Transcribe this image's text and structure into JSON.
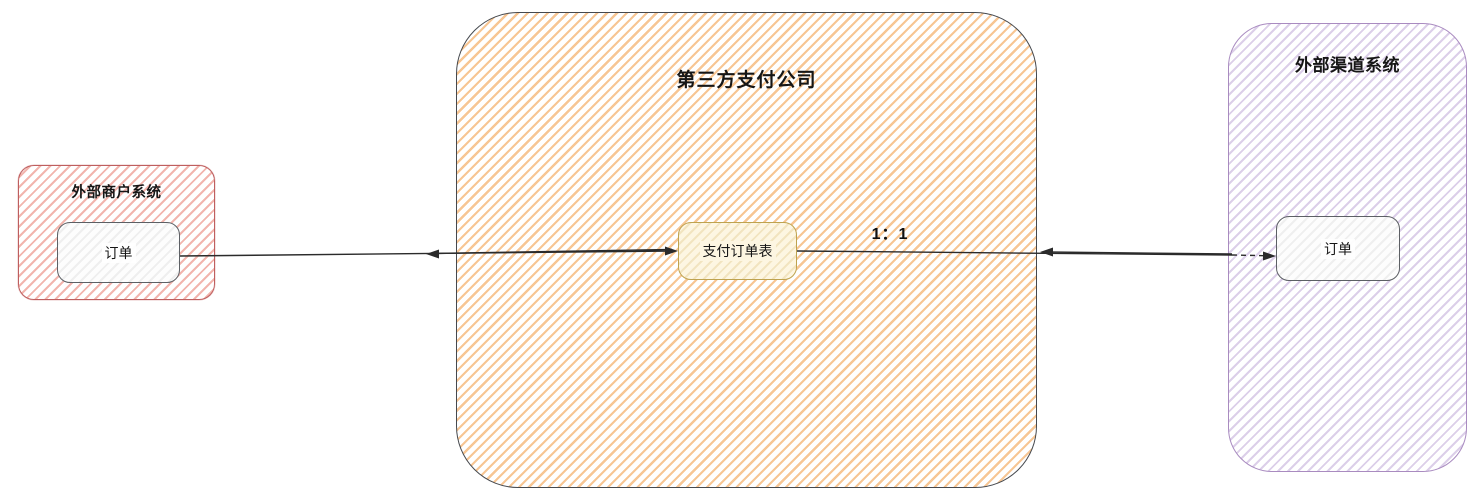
{
  "canvas": {
    "width": 1481,
    "height": 492,
    "background": "#ffffff"
  },
  "nodes": {
    "merchant_system": {
      "label": "外部商户系统",
      "border_color": "#bf5f5f",
      "hatch_color": "#f2b5ae"
    },
    "merchant_order": {
      "label": "订单",
      "border_color": "#5d6065"
    },
    "payment_company": {
      "label": "第三方支付公司",
      "border_color": "#46494e",
      "hatch_color": "#f7c694"
    },
    "payment_order_table": {
      "label": "支付订单表",
      "border_color": "#bfa34f",
      "fill_color": "#fdf6e2"
    },
    "channel_system": {
      "label": "外部渠道系统",
      "border_color": "#a98bc0",
      "hatch_color": "#dccfe9"
    },
    "channel_order": {
      "label": "订单",
      "border_color": "#5d6065"
    }
  },
  "edges": {
    "merchant_to_payment": {
      "style": "solid",
      "arrowheads": "both"
    },
    "payment_to_channel": {
      "style": "solid-then-dashed",
      "arrowheads": "both",
      "ratio_label": "1：1"
    }
  }
}
